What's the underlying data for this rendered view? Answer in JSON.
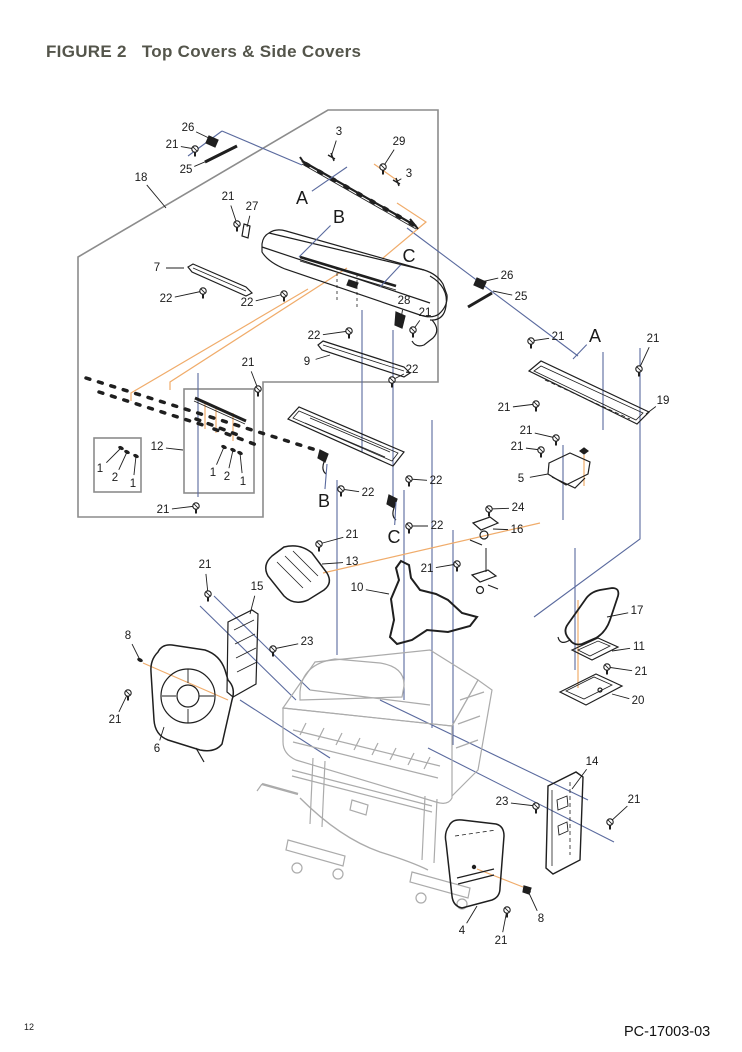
{
  "page": {
    "title": "FIGURE 2   Top Covers & Side Covers",
    "page_number": "12",
    "doc_number": "PC-17003-03"
  },
  "colors": {
    "title_text": "#54554B",
    "drawing_ink": "#1F1F1F",
    "leader_blue": "#5A6A9E",
    "leader_orange": "#F0AC6B",
    "boundary_gray": "#8C8C8C",
    "printer_gray": "#ABABAB"
  },
  "diagram": {
    "callouts": [
      {
        "label": "26",
        "x": 188,
        "y": 128,
        "tx": 213,
        "ty": 140,
        "kind": "part"
      },
      {
        "label": "21",
        "x": 172,
        "y": 145,
        "tx": 195,
        "ty": 149,
        "kind": "screw"
      },
      {
        "label": "25",
        "x": 186,
        "y": 170,
        "tx": 214,
        "ty": 158,
        "kind": "part"
      },
      {
        "label": "18",
        "x": 141,
        "y": 178,
        "tx": 166,
        "ty": 208,
        "kind": "part"
      },
      {
        "label": "3",
        "x": 339,
        "y": 132,
        "tx": 331,
        "ty": 157,
        "kind": "part"
      },
      {
        "label": "29",
        "x": 399,
        "y": 142,
        "tx": 383,
        "ty": 167,
        "kind": "screw"
      },
      {
        "label": "3",
        "x": 409,
        "y": 174,
        "tx": 396,
        "ty": 182,
        "kind": "part"
      },
      {
        "label": "A",
        "x": 302,
        "y": 198,
        "tx": 347,
        "ty": 167,
        "kind": "letter"
      },
      {
        "label": "21",
        "x": 228,
        "y": 197,
        "tx": 237,
        "ty": 224,
        "kind": "screw"
      },
      {
        "label": "27",
        "x": 252,
        "y": 207,
        "tx": 247,
        "ty": 227,
        "kind": "part"
      },
      {
        "label": "B",
        "x": 339,
        "y": 217,
        "tx": 299,
        "ty": 257,
        "kind": "letter"
      },
      {
        "label": "7",
        "x": 157,
        "y": 268,
        "tx": 184,
        "ty": 268,
        "kind": "part"
      },
      {
        "label": "22",
        "x": 166,
        "y": 299,
        "tx": 203,
        "ty": 291,
        "kind": "screw"
      },
      {
        "label": "22",
        "x": 247,
        "y": 303,
        "tx": 284,
        "ty": 294,
        "kind": "screw"
      },
      {
        "label": "C",
        "x": 409,
        "y": 256,
        "tx": 380,
        "ty": 287,
        "kind": "letter"
      },
      {
        "label": "26",
        "x": 507,
        "y": 276,
        "tx": 481,
        "ty": 282,
        "kind": "part"
      },
      {
        "label": "25",
        "x": 521,
        "y": 297,
        "tx": 493,
        "ty": 291,
        "kind": "part"
      },
      {
        "label": "28",
        "x": 404,
        "y": 301,
        "tx": 401,
        "ty": 319,
        "kind": "part"
      },
      {
        "label": "21",
        "x": 425,
        "y": 313,
        "tx": 413,
        "ty": 330,
        "kind": "screw"
      },
      {
        "label": "22",
        "x": 314,
        "y": 336,
        "tx": 349,
        "ty": 331,
        "kind": "screw"
      },
      {
        "label": "9",
        "x": 307,
        "y": 362,
        "tx": 330,
        "ty": 355,
        "kind": "part"
      },
      {
        "label": "22",
        "x": 412,
        "y": 370,
        "tx": 392,
        "ty": 380,
        "kind": "screw"
      },
      {
        "label": "21",
        "x": 248,
        "y": 363,
        "tx": 258,
        "ty": 389,
        "kind": "screw"
      },
      {
        "label": "12",
        "x": 157,
        "y": 447,
        "tx": 183,
        "ty": 450,
        "kind": "part"
      },
      {
        "label": "1",
        "x": 100,
        "y": 469,
        "tx": 121,
        "ty": 448,
        "kind": "pin"
      },
      {
        "label": "2",
        "x": 115,
        "y": 478,
        "tx": 127,
        "ty": 452,
        "kind": "pin"
      },
      {
        "label": "1",
        "x": 133,
        "y": 484,
        "tx": 136,
        "ty": 456,
        "kind": "pin"
      },
      {
        "label": "1",
        "x": 213,
        "y": 473,
        "tx": 224,
        "ty": 447,
        "kind": "pin"
      },
      {
        "label": "2",
        "x": 227,
        "y": 477,
        "tx": 233,
        "ty": 450,
        "kind": "pin"
      },
      {
        "label": "1",
        "x": 243,
        "y": 482,
        "tx": 240,
        "ty": 453,
        "kind": "pin"
      },
      {
        "label": "21",
        "x": 163,
        "y": 510,
        "tx": 196,
        "ty": 506,
        "kind": "screw"
      },
      {
        "label": "A",
        "x": 595,
        "y": 336,
        "tx": 573,
        "ty": 359,
        "kind": "letter"
      },
      {
        "label": "21",
        "x": 558,
        "y": 337,
        "tx": 531,
        "ty": 341,
        "kind": "screw"
      },
      {
        "label": "21",
        "x": 653,
        "y": 339,
        "tx": 639,
        "ty": 369,
        "kind": "screw"
      },
      {
        "label": "21",
        "x": 504,
        "y": 408,
        "tx": 536,
        "ty": 404,
        "kind": "screw"
      },
      {
        "label": "19",
        "x": 663,
        "y": 401,
        "tx": 646,
        "ty": 414,
        "kind": "part"
      },
      {
        "label": "21",
        "x": 526,
        "y": 431,
        "tx": 556,
        "ty": 438,
        "kind": "screw"
      },
      {
        "label": "21",
        "x": 517,
        "y": 447,
        "tx": 541,
        "ty": 450,
        "kind": "screw"
      },
      {
        "label": "5",
        "x": 521,
        "y": 479,
        "tx": 548,
        "ty": 474,
        "kind": "part"
      },
      {
        "label": "24",
        "x": 518,
        "y": 508,
        "tx": 489,
        "ty": 509,
        "kind": "screw"
      },
      {
        "label": "16",
        "x": 517,
        "y": 530,
        "tx": 493,
        "ty": 529,
        "kind": "part"
      },
      {
        "label": "17",
        "x": 637,
        "y": 611,
        "tx": 607,
        "ty": 617,
        "kind": "part"
      },
      {
        "label": "11",
        "x": 639,
        "y": 647,
        "tx": 612,
        "ty": 651,
        "kind": "part"
      },
      {
        "label": "21",
        "x": 641,
        "y": 672,
        "tx": 607,
        "ty": 667,
        "kind": "screw"
      },
      {
        "label": "20",
        "x": 638,
        "y": 701,
        "tx": 612,
        "ty": 694,
        "kind": "part"
      },
      {
        "label": "14",
        "x": 592,
        "y": 762,
        "tx": 572,
        "ty": 789,
        "kind": "part"
      },
      {
        "label": "23",
        "x": 502,
        "y": 802,
        "tx": 536,
        "ty": 806,
        "kind": "screw"
      },
      {
        "label": "21",
        "x": 634,
        "y": 800,
        "tx": 610,
        "ty": 822,
        "kind": "screw"
      },
      {
        "label": "8",
        "x": 541,
        "y": 919,
        "tx": 528,
        "ty": 891,
        "kind": "pin"
      },
      {
        "label": "4",
        "x": 462,
        "y": 931,
        "tx": 477,
        "ty": 906,
        "kind": "part"
      },
      {
        "label": "21",
        "x": 501,
        "y": 941,
        "tx": 507,
        "ty": 910,
        "kind": "screw"
      },
      {
        "label": "21",
        "x": 352,
        "y": 535,
        "tx": 319,
        "ty": 544,
        "kind": "screw"
      },
      {
        "label": "13",
        "x": 352,
        "y": 562,
        "tx": 322,
        "ty": 564,
        "kind": "part"
      },
      {
        "label": "10",
        "x": 357,
        "y": 588,
        "tx": 389,
        "ty": 594,
        "kind": "part"
      },
      {
        "label": "21",
        "x": 427,
        "y": 569,
        "tx": 457,
        "ty": 564,
        "kind": "screw"
      },
      {
        "label": "21",
        "x": 205,
        "y": 565,
        "tx": 208,
        "ty": 594,
        "kind": "screw"
      },
      {
        "label": "15",
        "x": 257,
        "y": 587,
        "tx": 250,
        "ty": 614,
        "kind": "part"
      },
      {
        "label": "8",
        "x": 128,
        "y": 636,
        "tx": 140,
        "ty": 660,
        "kind": "pin"
      },
      {
        "label": "23",
        "x": 307,
        "y": 642,
        "tx": 273,
        "ty": 649,
        "kind": "screw"
      },
      {
        "label": "21",
        "x": 115,
        "y": 720,
        "tx": 128,
        "ty": 693,
        "kind": "screw"
      },
      {
        "label": "6",
        "x": 157,
        "y": 749,
        "tx": 164,
        "ty": 727,
        "kind": "part"
      },
      {
        "label": "B",
        "x": 324,
        "y": 501,
        "tx": 327,
        "ty": 464,
        "kind": "letter"
      },
      {
        "label": "C",
        "x": 394,
        "y": 537,
        "tx": 396,
        "ty": 502,
        "kind": "letter"
      },
      {
        "label": "22",
        "x": 368,
        "y": 493,
        "tx": 341,
        "ty": 489,
        "kind": "screw"
      },
      {
        "label": "22",
        "x": 436,
        "y": 481,
        "tx": 409,
        "ty": 479,
        "kind": "screw"
      },
      {
        "label": "22",
        "x": 437,
        "y": 526,
        "tx": 409,
        "ty": 526,
        "kind": "screw"
      }
    ]
  }
}
